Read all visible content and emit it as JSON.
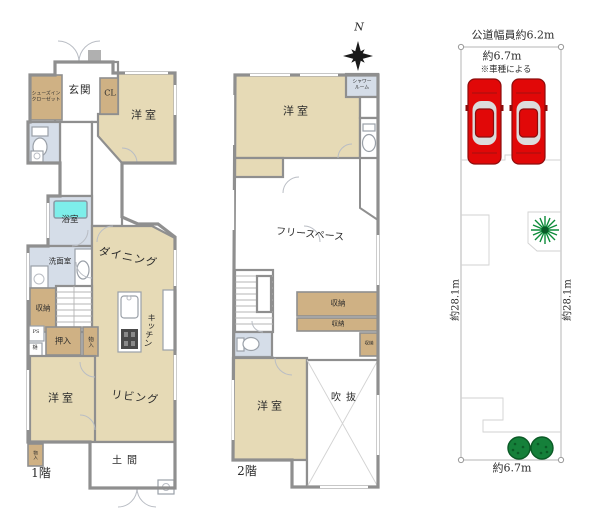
{
  "floor1": {
    "title": "1階",
    "genkan": "玄関",
    "shoes_closet_1": "シューズイン",
    "shoes_closet_2": "クローゼット",
    "cl": "CL",
    "bedroom_top": "洋室",
    "bath": "浴室",
    "washroom": "洗面室",
    "dining": "ダイニング",
    "kitchen": "キッチン",
    "storage": "収納",
    "ps": "PS",
    "gutter": "樋",
    "oshiire": "押入",
    "monoire": "物入",
    "bedroom_bottom": "洋室",
    "living": "リビング",
    "doma": "土間",
    "monoire_small": "物入"
  },
  "floor2": {
    "title": "2階",
    "bedroom_top": "洋室",
    "shower_1": "シャワー",
    "shower_2": "ルーム",
    "free_space": "フリースペース",
    "storage_1": "収納",
    "storage_2": "収納",
    "storage_3": "収納",
    "bedroom_bottom": "洋室",
    "void": "吹抜"
  },
  "site": {
    "road_width": "公道幅員約6.2m",
    "frontage_top": "約6.7m",
    "car_note": "※車種による",
    "depth_left": "約28.1m",
    "depth_right": "約28.1m",
    "frontage_bottom": "約6.7m"
  },
  "compass": {
    "north": "N"
  },
  "colors": {
    "room": "#e6dab6",
    "closet": "#cfb184",
    "water": "#d5dde8",
    "tub": "#7deeea",
    "wall": "#8f8f8f",
    "car": "#e10808",
    "tree": "#15803a"
  }
}
